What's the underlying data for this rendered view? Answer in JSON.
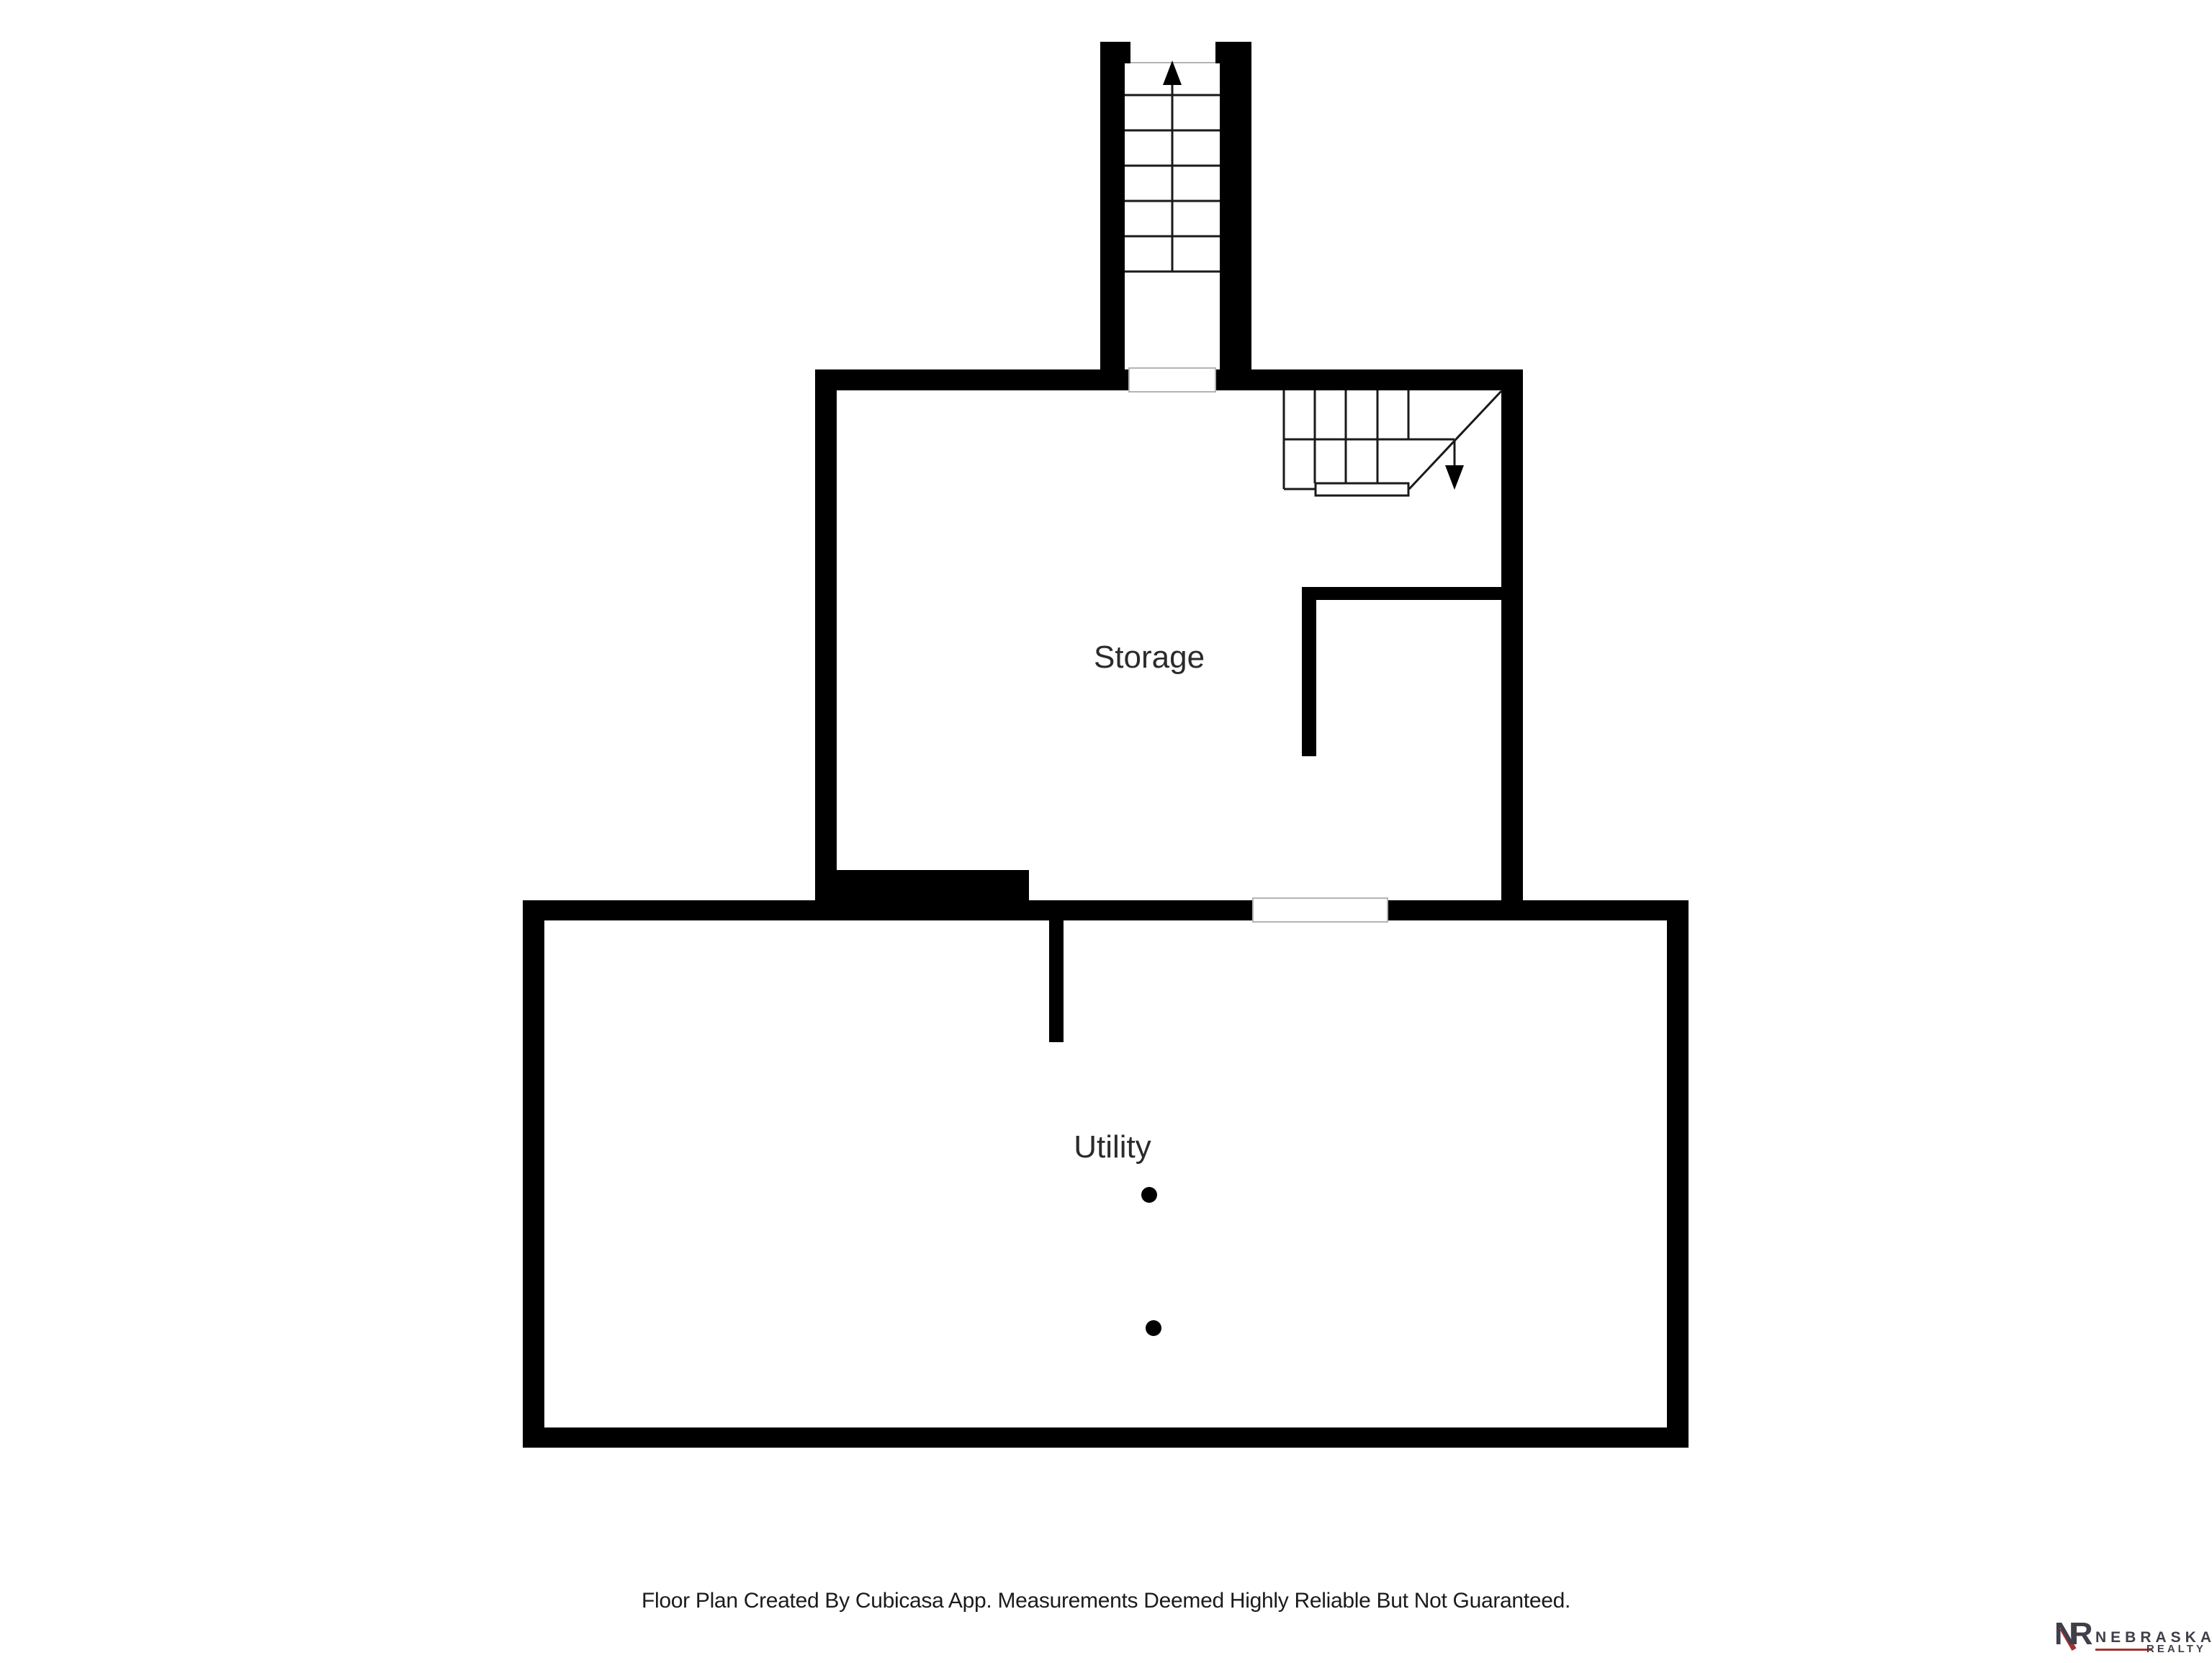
{
  "floorplan": {
    "rooms": [
      {
        "id": "storage",
        "label": "Storage"
      },
      {
        "id": "utility",
        "label": "Utility"
      }
    ],
    "stairs": [
      {
        "id": "stairs-up",
        "direction": "up"
      },
      {
        "id": "stairs-down",
        "direction": "down"
      }
    ],
    "colors": {
      "wall": "#000000",
      "stair_line": "#1a1a1a",
      "door_outline": "#b4b4b4",
      "label_text": "#2b2b2b",
      "footer_text": "#1b1b1b"
    },
    "footer": "Floor Plan Created By Cubicasa App. Measurements Deemed Highly Reliable But Not Guaranteed."
  },
  "logo": {
    "monogram": "NR",
    "name": "NEBRASKA",
    "subname": "REALTY",
    "colors": {
      "gray": "#403e48",
      "red": "#a23131"
    }
  }
}
